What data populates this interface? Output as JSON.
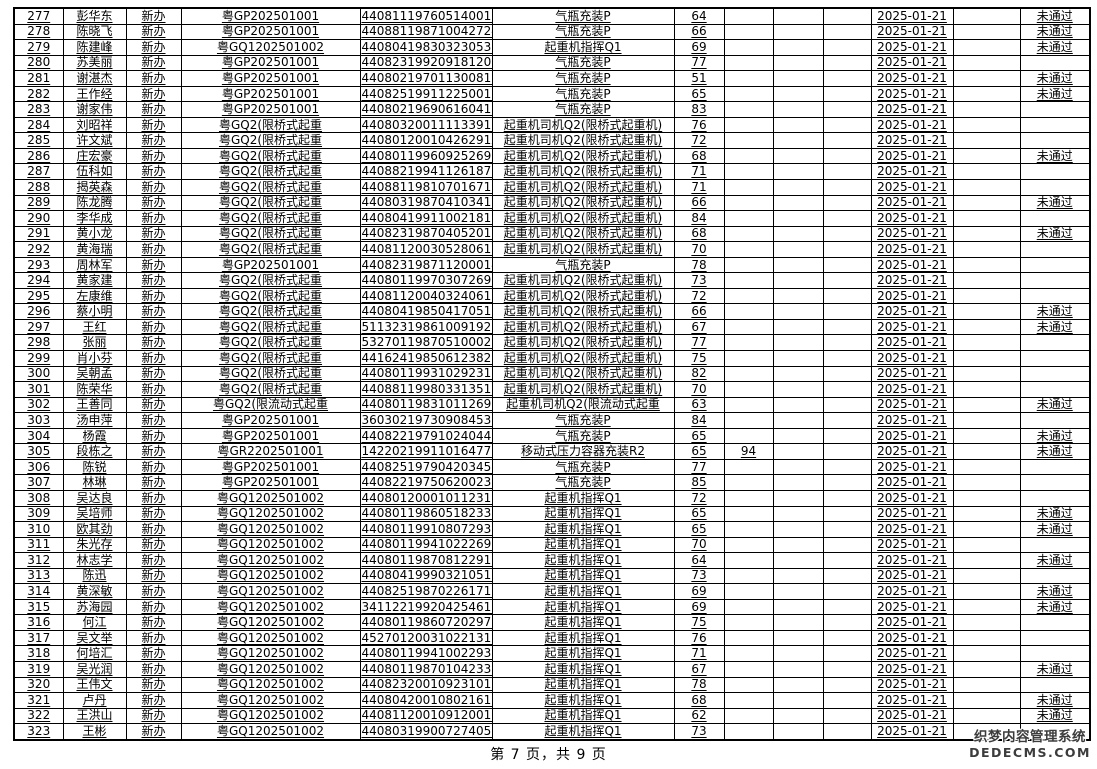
{
  "footer": {
    "page_text": "第 7 页，共 9 页"
  },
  "watermark": {
    "title": "织梦内容管理系统",
    "domain": "DEDECMS.COM"
  },
  "table": {
    "rows": [
      {
        "no": "277",
        "name": "彭华东",
        "type": "新办",
        "code": "粤GP202501001",
        "id": "440811197605140011",
        "category": "气瓶充装P",
        "score1": "64",
        "score2": "",
        "date": "2025-01-21",
        "status": "未通过"
      },
      {
        "no": "278",
        "name": "陈晓飞",
        "type": "新办",
        "code": "粤GP202501001",
        "id": "440881198710042724",
        "category": "气瓶充装P",
        "score1": "66",
        "score2": "",
        "date": "2025-01-21",
        "status": "未通过"
      },
      {
        "no": "279",
        "name": "陈建峰",
        "type": "新办",
        "code": "粤GQ1202501002",
        "id": "440804198303230530",
        "category": "起重机指挥Q1",
        "score1": "69",
        "score2": "",
        "date": "2025-01-21",
        "status": "未通过"
      },
      {
        "no": "280",
        "name": "苏美丽",
        "type": "新办",
        "code": "粤GP202501001",
        "id": "440823199209181203",
        "category": "气瓶充装P",
        "score1": "77",
        "score2": "",
        "date": "2025-01-21",
        "status": ""
      },
      {
        "no": "281",
        "name": "谢湛杰",
        "type": "新办",
        "code": "粤GP202501001",
        "id": "440802197011300819",
        "category": "气瓶充装P",
        "score1": "51",
        "score2": "",
        "date": "2025-01-21",
        "status": "未通过"
      },
      {
        "no": "282",
        "name": "王作经",
        "type": "新办",
        "code": "粤GP202501001",
        "id": "440825199112250017",
        "category": "气瓶充装P",
        "score1": "65",
        "score2": "",
        "date": "2025-01-21",
        "status": "未通过"
      },
      {
        "no": "283",
        "name": "谢家伟",
        "type": "新办",
        "code": "粤GP202501001",
        "id": "440802196906160410",
        "category": "气瓶充装P",
        "score1": "83",
        "score2": "",
        "date": "2025-01-21",
        "status": ""
      },
      {
        "no": "284",
        "name": "刘昭祥",
        "type": "新办",
        "code": "粤GQ2(限桥式起重",
        "id": "440803200111133916",
        "category": "起重机司机Q2(限桥式起重机)",
        "score1": "76",
        "score2": "",
        "date": "2025-01-21",
        "status": ""
      },
      {
        "no": "285",
        "name": "许文斌",
        "type": "新办",
        "code": "粤GQ2(限桥式起重",
        "id": "44080120010426291X",
        "category": "起重机司机Q2(限桥式起重机)",
        "score1": "72",
        "score2": "",
        "date": "2025-01-21",
        "status": ""
      },
      {
        "no": "286",
        "name": "庄宏豪",
        "type": "新办",
        "code": "粤GQ2(限桥式起重",
        "id": "440801199609252690",
        "category": "起重机司机Q2(限桥式起重机)",
        "score1": "68",
        "score2": "",
        "date": "2025-01-21",
        "status": "未通过"
      },
      {
        "no": "287",
        "name": "伍科如",
        "type": "新办",
        "code": "粤GQ2(限桥式起重",
        "id": "440882199411261872",
        "category": "起重机司机Q2(限桥式起重机)",
        "score1": "71",
        "score2": "",
        "date": "2025-01-21",
        "status": ""
      },
      {
        "no": "288",
        "name": "揭英森",
        "type": "新办",
        "code": "粤GQ2(限桥式起重",
        "id": "440881198107016716",
        "category": "起重机司机Q2(限桥式起重机)",
        "score1": "71",
        "score2": "",
        "date": "2025-01-21",
        "status": ""
      },
      {
        "no": "289",
        "name": "陈龙腾",
        "type": "新办",
        "code": "粤GQ2(限桥式起重",
        "id": "440803198704103413",
        "category": "起重机司机Q2(限桥式起重机)",
        "score1": "66",
        "score2": "",
        "date": "2025-01-21",
        "status": "未通过"
      },
      {
        "no": "290",
        "name": "李华成",
        "type": "新办",
        "code": "粤GQ2(限桥式起重",
        "id": "440804199110021817",
        "category": "起重机司机Q2(限桥式起重机)",
        "score1": "84",
        "score2": "",
        "date": "2025-01-21",
        "status": ""
      },
      {
        "no": "291",
        "name": "黄小龙",
        "type": "新办",
        "code": "粤GQ2(限桥式起重",
        "id": "440823198704052017",
        "category": "起重机司机Q2(限桥式起重机)",
        "score1": "68",
        "score2": "",
        "date": "2025-01-21",
        "status": "未通过"
      },
      {
        "no": "292",
        "name": "黄海瑞",
        "type": "新办",
        "code": "粤GQ2(限桥式起重",
        "id": "440811200305280615",
        "category": "起重机司机Q2(限桥式起重机)",
        "score1": "70",
        "score2": "",
        "date": "2025-01-21",
        "status": ""
      },
      {
        "no": "293",
        "name": "周林军",
        "type": "新办",
        "code": "粤GP202501001",
        "id": "440823198711200014",
        "category": "气瓶充装P",
        "score1": "78",
        "score2": "",
        "date": "2025-01-21",
        "status": ""
      },
      {
        "no": "294",
        "name": "黄家建",
        "type": "新办",
        "code": "粤GQ2(限桥式起重",
        "id": "440801199703072696",
        "category": "起重机司机Q2(限桥式起重机)",
        "score1": "73",
        "score2": "",
        "date": "2025-01-21",
        "status": ""
      },
      {
        "no": "295",
        "name": "左康维",
        "type": "新办",
        "code": "粤GQ2(限桥式起重",
        "id": "440811200403240617",
        "category": "起重机司机Q2(限桥式起重机)",
        "score1": "72",
        "score2": "",
        "date": "2025-01-21",
        "status": ""
      },
      {
        "no": "296",
        "name": "蔡小明",
        "type": "新办",
        "code": "粤GQ2(限桥式起重",
        "id": "440804198504170511",
        "category": "起重机司机Q2(限桥式起重机)",
        "score1": "66",
        "score2": "",
        "date": "2025-01-21",
        "status": "未通过"
      },
      {
        "no": "297",
        "name": "王红",
        "type": "新办",
        "code": "粤GQ2(限桥式起重",
        "id": "511323198610091922",
        "category": "起重机司机Q2(限桥式起重机)",
        "score1": "67",
        "score2": "",
        "date": "2025-01-21",
        "status": "未通过"
      },
      {
        "no": "298",
        "name": "张丽",
        "type": "新办",
        "code": "粤GQ2(限桥式起重",
        "id": "532701198705100025",
        "category": "起重机司机Q2(限桥式起重机)",
        "score1": "77",
        "score2": "",
        "date": "2025-01-21",
        "status": ""
      },
      {
        "no": "299",
        "name": "肖小芬",
        "type": "新办",
        "code": "粤GQ2(限桥式起重",
        "id": "441624198506123829",
        "category": "起重机司机Q2(限桥式起重机)",
        "score1": "75",
        "score2": "",
        "date": "2025-01-21",
        "status": ""
      },
      {
        "no": "300",
        "name": "吴朝孟",
        "type": "新办",
        "code": "粤GQ2(限桥式起重",
        "id": "440801199310292313",
        "category": "起重机司机Q2(限桥式起重机)",
        "score1": "82",
        "score2": "",
        "date": "2025-01-21",
        "status": ""
      },
      {
        "no": "301",
        "name": "陈荣华",
        "type": "新办",
        "code": "粤GQ2(限桥式起重",
        "id": "440881199803313516",
        "category": "起重机司机Q2(限桥式起重机)",
        "score1": "70",
        "score2": "",
        "date": "2025-01-21",
        "status": ""
      },
      {
        "no": "302",
        "name": "王善同",
        "type": "新办",
        "code": "粤GQ2(限流动式起重",
        "id": "440801198310112699",
        "category": "起重机司机Q2(限流动式起重",
        "score1": "63",
        "score2": "",
        "date": "2025-01-21",
        "status": "未通过"
      },
      {
        "no": "303",
        "name": "汤申萍",
        "type": "新办",
        "code": "粤GP202501001",
        "id": "360302197309084533",
        "category": "气瓶充装P",
        "score1": "84",
        "score2": "",
        "date": "2025-01-21",
        "status": ""
      },
      {
        "no": "304",
        "name": "杨霞",
        "type": "新办",
        "code": "粤GP202501001",
        "id": "440822197910240448",
        "category": "气瓶充装P",
        "score1": "65",
        "score2": "",
        "date": "2025-01-21",
        "status": "未通过"
      },
      {
        "no": "305",
        "name": "段栋之",
        "type": "新办",
        "code": "粤GR2202501001",
        "id": "142202199110164776",
        "category": "移动式压力容器充装R2",
        "score1": "65",
        "score2": "94",
        "date": "2025-01-21",
        "status": "未通过"
      },
      {
        "no": "306",
        "name": "陈锐",
        "type": "新办",
        "code": "粤GP202501001",
        "id": "440825197904203455",
        "category": "气瓶充装P",
        "score1": "77",
        "score2": "",
        "date": "2025-01-21",
        "status": ""
      },
      {
        "no": "307",
        "name": "林琳",
        "type": "新办",
        "code": "粤GP202501001",
        "id": "440822197506200233",
        "category": "气瓶充装P",
        "score1": "85",
        "score2": "",
        "date": "2025-01-21",
        "status": ""
      },
      {
        "no": "308",
        "name": "吴达良",
        "type": "新办",
        "code": "粤GQ1202501002",
        "id": "440801200010112312",
        "category": "起重机指挥Q1",
        "score1": "72",
        "score2": "",
        "date": "2025-01-21",
        "status": ""
      },
      {
        "no": "309",
        "name": "吴培师",
        "type": "新办",
        "code": "粤GQ1202501002",
        "id": "440801198605182336",
        "category": "起重机指挥Q1",
        "score1": "65",
        "score2": "",
        "date": "2025-01-21",
        "status": "未通过"
      },
      {
        "no": "310",
        "name": "欧其劲",
        "type": "新办",
        "code": "粤GQ1202501002",
        "id": "440801199108072931",
        "category": "起重机指挥Q1",
        "score1": "65",
        "score2": "",
        "date": "2025-01-21",
        "status": "未通过"
      },
      {
        "no": "311",
        "name": "朱光存",
        "type": "新办",
        "code": "粤GQ1202501002",
        "id": "440801199410222697",
        "category": "起重机指挥Q1",
        "score1": "70",
        "score2": "",
        "date": "2025-01-21",
        "status": ""
      },
      {
        "no": "312",
        "name": "林志学",
        "type": "新办",
        "code": "粤GQ1202501002",
        "id": "440801198708122918",
        "category": "起重机指挥Q1",
        "score1": "64",
        "score2": "",
        "date": "2025-01-21",
        "status": "未通过"
      },
      {
        "no": "313",
        "name": "陈迅",
        "type": "新办",
        "code": "粤GQ1202501002",
        "id": "440804199903210511",
        "category": "起重机指挥Q1",
        "score1": "73",
        "score2": "",
        "date": "2025-01-21",
        "status": ""
      },
      {
        "no": "314",
        "name": "黄深敏",
        "type": "新办",
        "code": "粤GQ1202501002",
        "id": "440825198702261715",
        "category": "起重机指挥Q1",
        "score1": "69",
        "score2": "",
        "date": "2025-01-21",
        "status": "未通过"
      },
      {
        "no": "315",
        "name": "苏海园",
        "type": "新办",
        "code": "粤GQ1202501002",
        "id": "341122199204254613",
        "category": "起重机指挥Q1",
        "score1": "69",
        "score2": "",
        "date": "2025-01-21",
        "status": "未通过"
      },
      {
        "no": "316",
        "name": "何江",
        "type": "新办",
        "code": "粤GQ1202501002",
        "id": "440801198607202978",
        "category": "起重机指挥Q1",
        "score1": "75",
        "score2": "",
        "date": "2025-01-21",
        "status": ""
      },
      {
        "no": "317",
        "name": "吴文举",
        "type": "新办",
        "code": "粤GQ1202501002",
        "id": "452701200310221316",
        "category": "起重机指挥Q1",
        "score1": "76",
        "score2": "",
        "date": "2025-01-21",
        "status": ""
      },
      {
        "no": "318",
        "name": "何培汇",
        "type": "新办",
        "code": "粤GQ1202501002",
        "id": "440801199410022935",
        "category": "起重机指挥Q1",
        "score1": "71",
        "score2": "",
        "date": "2025-01-21",
        "status": ""
      },
      {
        "no": "319",
        "name": "吴光润",
        "type": "新办",
        "code": "粤GQ1202501002",
        "id": "440801198701042333",
        "category": "起重机指挥Q1",
        "score1": "67",
        "score2": "",
        "date": "2025-01-21",
        "status": "未通过"
      },
      {
        "no": "320",
        "name": "王伟文",
        "type": "新办",
        "code": "粤GQ1202501002",
        "id": "440823200109231010",
        "category": "起重机指挥Q1",
        "score1": "78",
        "score2": "",
        "date": "2025-01-21",
        "status": ""
      },
      {
        "no": "321",
        "name": "卢丹",
        "type": "新办",
        "code": "粤GQ1202501002",
        "id": "440804200108021610",
        "category": "起重机指挥Q1",
        "score1": "68",
        "score2": "",
        "date": "2025-01-21",
        "status": "未通过"
      },
      {
        "no": "322",
        "name": "王洪山",
        "type": "新办",
        "code": "粤GQ1202501002",
        "id": "440811200109120016",
        "category": "起重机指挥Q1",
        "score1": "62",
        "score2": "",
        "date": "2025-01-21",
        "status": "未通过"
      },
      {
        "no": "323",
        "name": "王彬",
        "type": "新办",
        "code": "粤GQ1202501002",
        "id": "440803199007274051",
        "category": "起重机指挥Q1",
        "score1": "73",
        "score2": "",
        "date": "2025-01-21",
        "status": ""
      }
    ]
  }
}
